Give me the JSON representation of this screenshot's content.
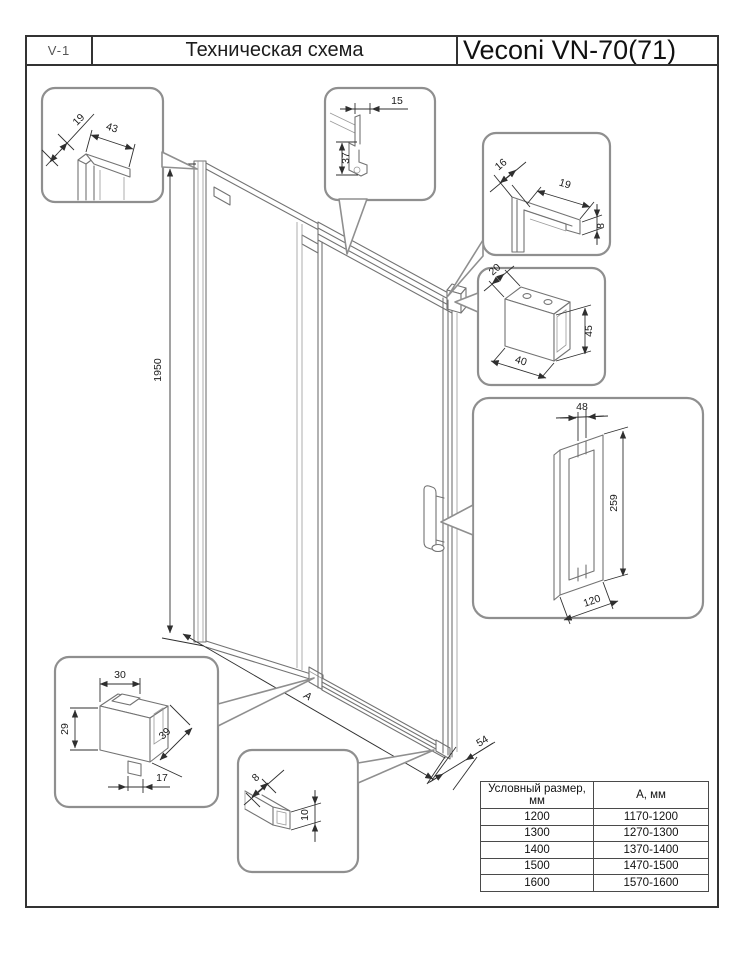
{
  "header": {
    "code": "V-1",
    "title": "Техническая схема",
    "product": "Veconi VN-70(71)"
  },
  "drawing": {
    "dim_height": "1950",
    "dim_width": "А",
    "dim_offset": "54"
  },
  "callouts": {
    "wall_profile": {
      "dim_a": "19",
      "dim_b": "43"
    },
    "top_rail": {
      "dim_a": "15",
      "dim_b": "37"
    },
    "rail_end": {
      "dim_a": "16",
      "dim_b": "19",
      "dim_c": "8"
    },
    "wall_bracket": {
      "dim_a": "20",
      "dim_b": "45",
      "dim_c": "40"
    },
    "handle": {
      "dim_a": "48",
      "dim_b": "259",
      "dim_c": "120"
    },
    "roller": {
      "dim_a": "30",
      "dim_b": "29",
      "dim_c": "39",
      "dim_d": "17"
    },
    "bottom_guide": {
      "dim_a": "8",
      "dim_b": "10"
    }
  },
  "size_table": {
    "headers": [
      "Условный размер, мм",
      "А, мм"
    ],
    "rows": [
      [
        "1200",
        "1170-1200"
      ],
      [
        "1300",
        "1270-1300"
      ],
      [
        "1400",
        "1370-1400"
      ],
      [
        "1500",
        "1470-1500"
      ],
      [
        "1600",
        "1570-1600"
      ]
    ]
  }
}
